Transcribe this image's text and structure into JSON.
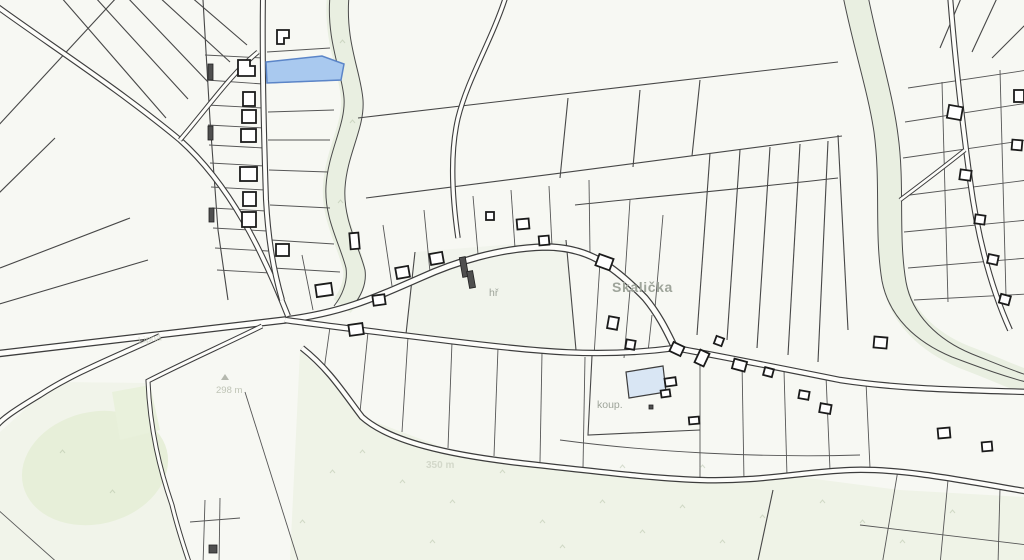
{
  "map": {
    "region_name": "Skalička",
    "labels": {
      "village": "Skalička",
      "playground_abbr": "hř",
      "pool_abbr": "koup.",
      "elevation_point": "298 m",
      "elevation_area": "350 m",
      "field_name": "Lipná"
    },
    "colors": {
      "background": "#f7f8f3",
      "parcel_line": "#474747",
      "road_fill": "#fdfdfa",
      "road_edge": "#3d3d3d",
      "building_fill": "#ffffff",
      "building_outline": "#1b1b1b",
      "building_dark": "#4f4f4f",
      "water_fill": "#a9c9ef",
      "water_outline": "#5b85c8",
      "pool_fill": "#d9e6f4",
      "green_tint": "#edf2e4",
      "meadow_tint": "#eff3e7",
      "label_color": "#9ea49a"
    }
  }
}
